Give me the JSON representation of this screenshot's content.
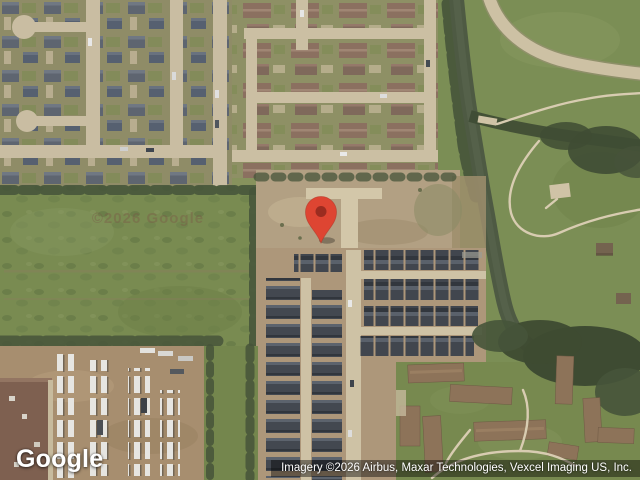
{
  "page": {
    "width": 640,
    "height": 480,
    "kind": "satellite map view with location marker"
  },
  "map": {
    "watermark": "©2026 Google",
    "marker": {
      "color": "#DE4532",
      "inner_color": "#93291E",
      "outline_color": "#B23527"
    }
  },
  "footer": {
    "logo_text": "Google",
    "attribution_text": "Imagery ©2026 Airbus, Maxar Technologies, Vexcel Imaging US, Inc."
  },
  "palette": {
    "grass": "#7B8E55",
    "field_green": "#798B51",
    "trees_dark": "#46543A",
    "water": "#4E5A43",
    "road_tan": "#CDC1A4",
    "dirt": "#B2A083",
    "roof_gray": "#5E6570",
    "roof_brown": "#8B7060",
    "roof_dark": "#41464E",
    "truck_yard_dirt": "#A78E6F",
    "attribution_bg": "rgba(0,0,0,0.42)"
  }
}
